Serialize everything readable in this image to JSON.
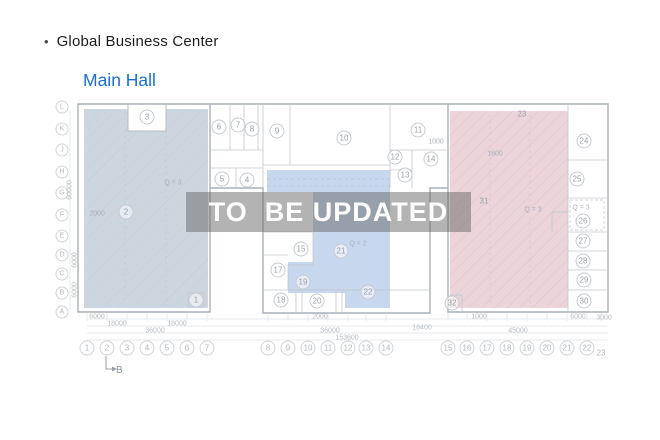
{
  "header": {
    "bullet": "•",
    "title": "Global Business Center",
    "subtitle": "Main Hall"
  },
  "watermark": "TO  BE UPDATED",
  "colors": {
    "left_zone": "#cdd5df",
    "middle_zone": "#c7d7ee",
    "right_zone": "#ecd4db",
    "accent_blue": "#1870d2",
    "watermark_band": "#686868"
  },
  "plan": {
    "row_labels": [
      "L",
      "K",
      "J",
      "H",
      "G",
      "F",
      "E",
      "D",
      "C",
      "B",
      "A"
    ],
    "col_labels": [
      "1",
      "2",
      "3",
      "4",
      "5",
      "6",
      "7",
      "8",
      "9",
      "10",
      "11",
      "12",
      "13",
      "14",
      "15",
      "16",
      "17",
      "18",
      "19",
      "20",
      "21",
      "22",
      "23"
    ],
    "room_numbers": [
      "1",
      "2",
      "3",
      "4",
      "5",
      "6",
      "7",
      "8",
      "9",
      "10",
      "11",
      "12",
      "13",
      "14",
      "15",
      "17",
      "18",
      "19",
      "20",
      "21",
      "22",
      "23",
      "24",
      "25",
      "26",
      "27",
      "28",
      "29",
      "30",
      "31",
      "32"
    ],
    "annotations": [
      "Q = 3",
      "2000",
      "Q = 2",
      "Q = 3",
      "Q = 3",
      "1000",
      "1800"
    ],
    "dims_bottom": [
      "6000",
      "2000",
      "1000",
      "6000",
      "3000",
      "18000",
      "18000",
      "18400",
      "36000",
      "36000",
      "45000",
      "153600"
    ],
    "dims_left": [
      "60000",
      "6000",
      "6000"
    ],
    "section_marker": "B"
  }
}
